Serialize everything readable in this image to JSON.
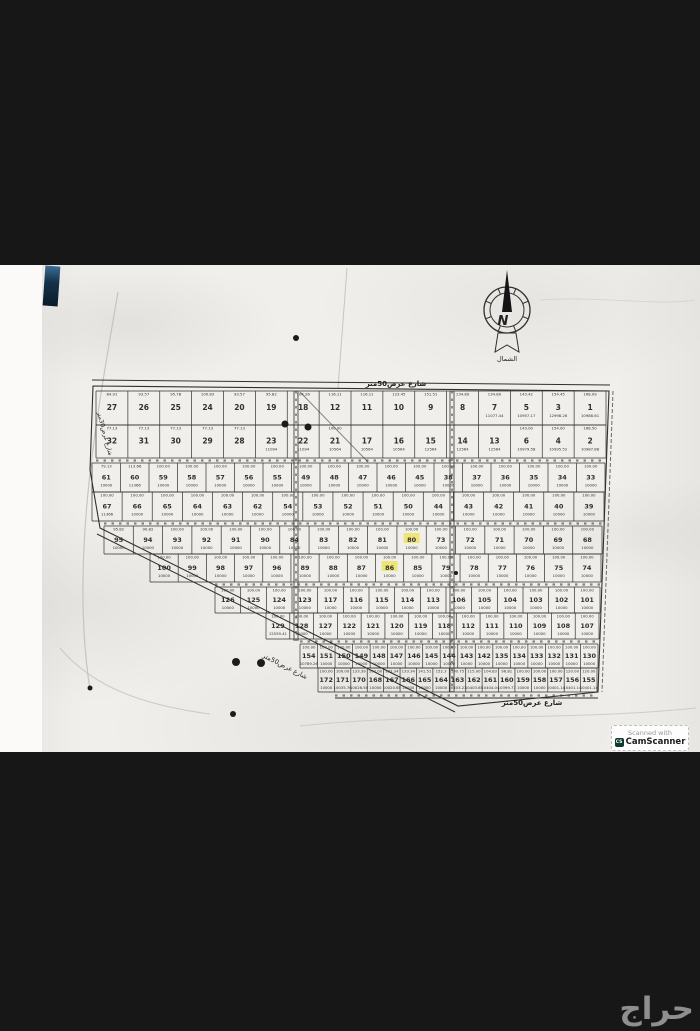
{
  "page": {
    "background": "#171717"
  },
  "compass": {
    "letter": "N",
    "label": "الشمال"
  },
  "badge": {
    "line1": "Scanned with",
    "line2": "CamScanner",
    "icon_text": "CS",
    "icon_color": "#0d3b2e"
  },
  "watermark": {
    "text": "حراج",
    "color": "#8f8f8f"
  },
  "map": {
    "ink": "#32302b",
    "highlight": "#ede25e",
    "defaults": {
      "width": "100.00",
      "area": "10000"
    },
    "street_labels": {
      "top": "شارع عرض50متر",
      "bottom": "شارع عرض50متر",
      "diagonal": "شارع عرض50متر",
      "left": "شارع عرض30متر"
    },
    "rows": [
      {
        "y0": 391,
        "y1": 425,
        "x0": 96,
        "x1": 606,
        "big": true,
        "defaults": false,
        "cells": [
          {
            "n": "27",
            "w": "84.91"
          },
          {
            "n": "26",
            "w": "93.57"
          },
          {
            "n": "25",
            "w": "95.78"
          },
          {
            "n": "24",
            "w": "100.83"
          },
          {
            "n": "20",
            "w": "93.57"
          },
          {
            "n": "19",
            "w": "95.82"
          },
          {
            "n": "18",
            "w": "104.26"
          },
          {
            "n": "12",
            "w": "116.11"
          },
          {
            "n": "11",
            "w": "116.11"
          },
          {
            "n": "10",
            "w": "123.45"
          },
          {
            "n": "9",
            "w": "151.51"
          },
          {
            "n": "8",
            "w": "134.89"
          },
          {
            "n": "7",
            "w": "134.89",
            "a": "11077.44"
          },
          {
            "n": "5",
            "w": "143.42",
            "a": "10957.17"
          },
          {
            "n": "3",
            "w": "154.45",
            "a": "12998.26"
          },
          {
            "n": "1",
            "w": "168.09",
            "a": "10988.61"
          }
        ]
      },
      {
        "y0": 425,
        "y1": 458,
        "x0": 96,
        "x1": 606,
        "big": true,
        "defaults": false,
        "cells": [
          {
            "n": "32",
            "w": "77.13"
          },
          {
            "n": "31",
            "w": "77.13"
          },
          {
            "n": "30",
            "w": "77.13"
          },
          {
            "n": "29",
            "w": "77.13"
          },
          {
            "n": "28",
            "w": "77.13"
          },
          {
            "n": "23",
            "a": "11094"
          },
          {
            "n": "22",
            "a": "11094"
          },
          {
            "n": "21",
            "w": "100.00",
            "a": "10564"
          },
          {
            "n": "17",
            "a": "10564"
          },
          {
            "n": "16",
            "a": "10564"
          },
          {
            "n": "15",
            "a": "12564"
          },
          {
            "n": "14",
            "a": "12564"
          },
          {
            "n": "13",
            "a": "12564"
          },
          {
            "n": "6",
            "w": "143.00",
            "a": "10979.58"
          },
          {
            "n": "4",
            "w": "154.00",
            "a": "10995.52"
          },
          {
            "n": "2",
            "w": "168.50",
            "a": "10987.88"
          }
        ]
      },
      {
        "y0": 463,
        "y1": 492,
        "x0": 92,
        "x1": 605,
        "defaults": true,
        "cells": [
          {
            "n": "61",
            "w": "79.13"
          },
          {
            "n": "60",
            "w": "113.66",
            "a": "11366"
          },
          {
            "n": "59"
          },
          {
            "n": "58"
          },
          {
            "n": "57"
          },
          {
            "n": "56"
          },
          {
            "n": "55"
          },
          {
            "n": "49"
          },
          {
            "n": "48"
          },
          {
            "n": "47"
          },
          {
            "n": "46"
          },
          {
            "n": "45"
          },
          {
            "n": "38"
          },
          {
            "n": "37"
          },
          {
            "n": "36"
          },
          {
            "n": "35"
          },
          {
            "n": "34"
          },
          {
            "n": "33"
          }
        ]
      },
      {
        "y0": 492,
        "y1": 521,
        "x0": 92,
        "x1": 604,
        "defaults": true,
        "cells": [
          {
            "n": "67",
            "a": "11366"
          },
          {
            "n": "66"
          },
          {
            "n": "65"
          },
          {
            "n": "64"
          },
          {
            "n": "63"
          },
          {
            "n": "62"
          },
          {
            "n": "54"
          },
          {
            "n": "53"
          },
          {
            "n": "52"
          },
          {
            "n": "51"
          },
          {
            "n": "50"
          },
          {
            "n": "44"
          },
          {
            "n": "43"
          },
          {
            "n": "42"
          },
          {
            "n": "41"
          },
          {
            "n": "40"
          },
          {
            "n": "39"
          }
        ]
      },
      {
        "y0": 526,
        "y1": 554,
        "x0": 104,
        "x1": 602,
        "defaults": true,
        "cells": [
          {
            "n": "95",
            "w": "95.82"
          },
          {
            "n": "94",
            "w": "90.82"
          },
          {
            "n": "93"
          },
          {
            "n": "92"
          },
          {
            "n": "91"
          },
          {
            "n": "90"
          },
          {
            "n": "84"
          },
          {
            "n": "83"
          },
          {
            "n": "82"
          },
          {
            "n": "81"
          },
          {
            "n": "80",
            "h": true
          },
          {
            "n": "73"
          },
          {
            "n": "72"
          },
          {
            "n": "71"
          },
          {
            "n": "70"
          },
          {
            "n": "69"
          },
          {
            "n": "68"
          }
        ]
      },
      {
        "y0": 554,
        "y1": 582,
        "x0": 150,
        "x1": 601,
        "defaults": true,
        "cells": [
          {
            "n": "100"
          },
          {
            "n": "99"
          },
          {
            "n": "98"
          },
          {
            "n": "97"
          },
          {
            "n": "96"
          },
          {
            "n": "89"
          },
          {
            "n": "88"
          },
          {
            "n": "87"
          },
          {
            "n": "86",
            "h": true
          },
          {
            "n": "85"
          },
          {
            "n": "79"
          },
          {
            "n": "78"
          },
          {
            "n": "77"
          },
          {
            "n": "76"
          },
          {
            "n": "75"
          },
          {
            "n": "74"
          }
        ]
      },
      {
        "y0": 587,
        "y1": 613,
        "x0": 215,
        "x1": 600,
        "defaults": true,
        "cells": [
          {
            "n": "126"
          },
          {
            "n": "125"
          },
          {
            "n": "124"
          },
          {
            "n": "123"
          },
          {
            "n": "117"
          },
          {
            "n": "116"
          },
          {
            "n": "115"
          },
          {
            "n": "114"
          },
          {
            "n": "113"
          },
          {
            "n": "106"
          },
          {
            "n": "105"
          },
          {
            "n": "104"
          },
          {
            "n": "103"
          },
          {
            "n": "102"
          },
          {
            "n": "101"
          }
        ]
      },
      {
        "y0": 613,
        "y1": 639,
        "x0": 266,
        "x1": 599,
        "defaults": true,
        "cells": [
          {
            "n": "129",
            "a": "12559.41"
          },
          {
            "n": "128"
          },
          {
            "n": "127"
          },
          {
            "n": "122"
          },
          {
            "n": "121"
          },
          {
            "n": "120"
          },
          {
            "n": "119"
          },
          {
            "n": "118"
          },
          {
            "n": "112"
          },
          {
            "n": "111"
          },
          {
            "n": "110"
          },
          {
            "n": "109"
          },
          {
            "n": "108"
          },
          {
            "n": "107"
          }
        ]
      },
      {
        "y0": 644,
        "y1": 668,
        "x0": 300,
        "x1": 598,
        "defaults": true,
        "cells": [
          {
            "n": "154",
            "a": "10789.26"
          },
          {
            "n": "151"
          },
          {
            "n": "150"
          },
          {
            "n": "149"
          },
          {
            "n": "148"
          },
          {
            "n": "147"
          },
          {
            "n": "146"
          },
          {
            "n": "145"
          },
          {
            "n": "144"
          },
          {
            "n": "143"
          },
          {
            "n": "142"
          },
          {
            "n": "135"
          },
          {
            "n": "134"
          },
          {
            "n": "133"
          },
          {
            "n": "132"
          },
          {
            "n": "131"
          },
          {
            "n": "130"
          }
        ]
      },
      {
        "y0": 668,
        "y1": 692,
        "x0": 318,
        "x1": 597,
        "defaults": true,
        "cells": [
          {
            "n": "172"
          },
          {
            "n": "171",
            "a": "10035.76"
          },
          {
            "n": "170",
            "a": "10026.50",
            "w": "133.39"
          },
          {
            "n": "168"
          },
          {
            "n": "167",
            "a": "10020.65",
            "w": "133.34"
          },
          {
            "n": "166",
            "w": "133.34"
          },
          {
            "n": "165",
            "w": "141.51"
          },
          {
            "n": "164",
            "w": "152.3"
          },
          {
            "n": "163",
            "a": "10403.23",
            "w": "130.75"
          },
          {
            "n": "162",
            "a": "10403.65",
            "w": "115.00"
          },
          {
            "n": "161",
            "a": "10404.04",
            "w": "104.83"
          },
          {
            "n": "160",
            "a": "10399.77",
            "w": "96.81"
          },
          {
            "n": "159"
          },
          {
            "n": "158"
          },
          {
            "n": "157",
            "a": "10401.14"
          },
          {
            "n": "156",
            "a": "10401.14",
            "w": "120.00"
          },
          {
            "n": "155",
            "a": "10401.14",
            "w": "120.00"
          }
        ]
      }
    ],
    "v_streets": [
      {
        "x": 296,
        "y0": 391,
        "y1": 641
      },
      {
        "x": 452,
        "y0": 391,
        "y1": 692
      }
    ],
    "dots": [
      [
        296,
        338,
        3
      ],
      [
        285,
        424,
        3.5
      ],
      [
        308,
        427,
        3.5
      ],
      [
        236,
        662,
        4
      ],
      [
        261,
        663,
        4
      ],
      [
        233,
        714,
        3
      ],
      [
        90,
        688,
        2.5
      ],
      [
        456,
        573,
        2
      ]
    ]
  }
}
